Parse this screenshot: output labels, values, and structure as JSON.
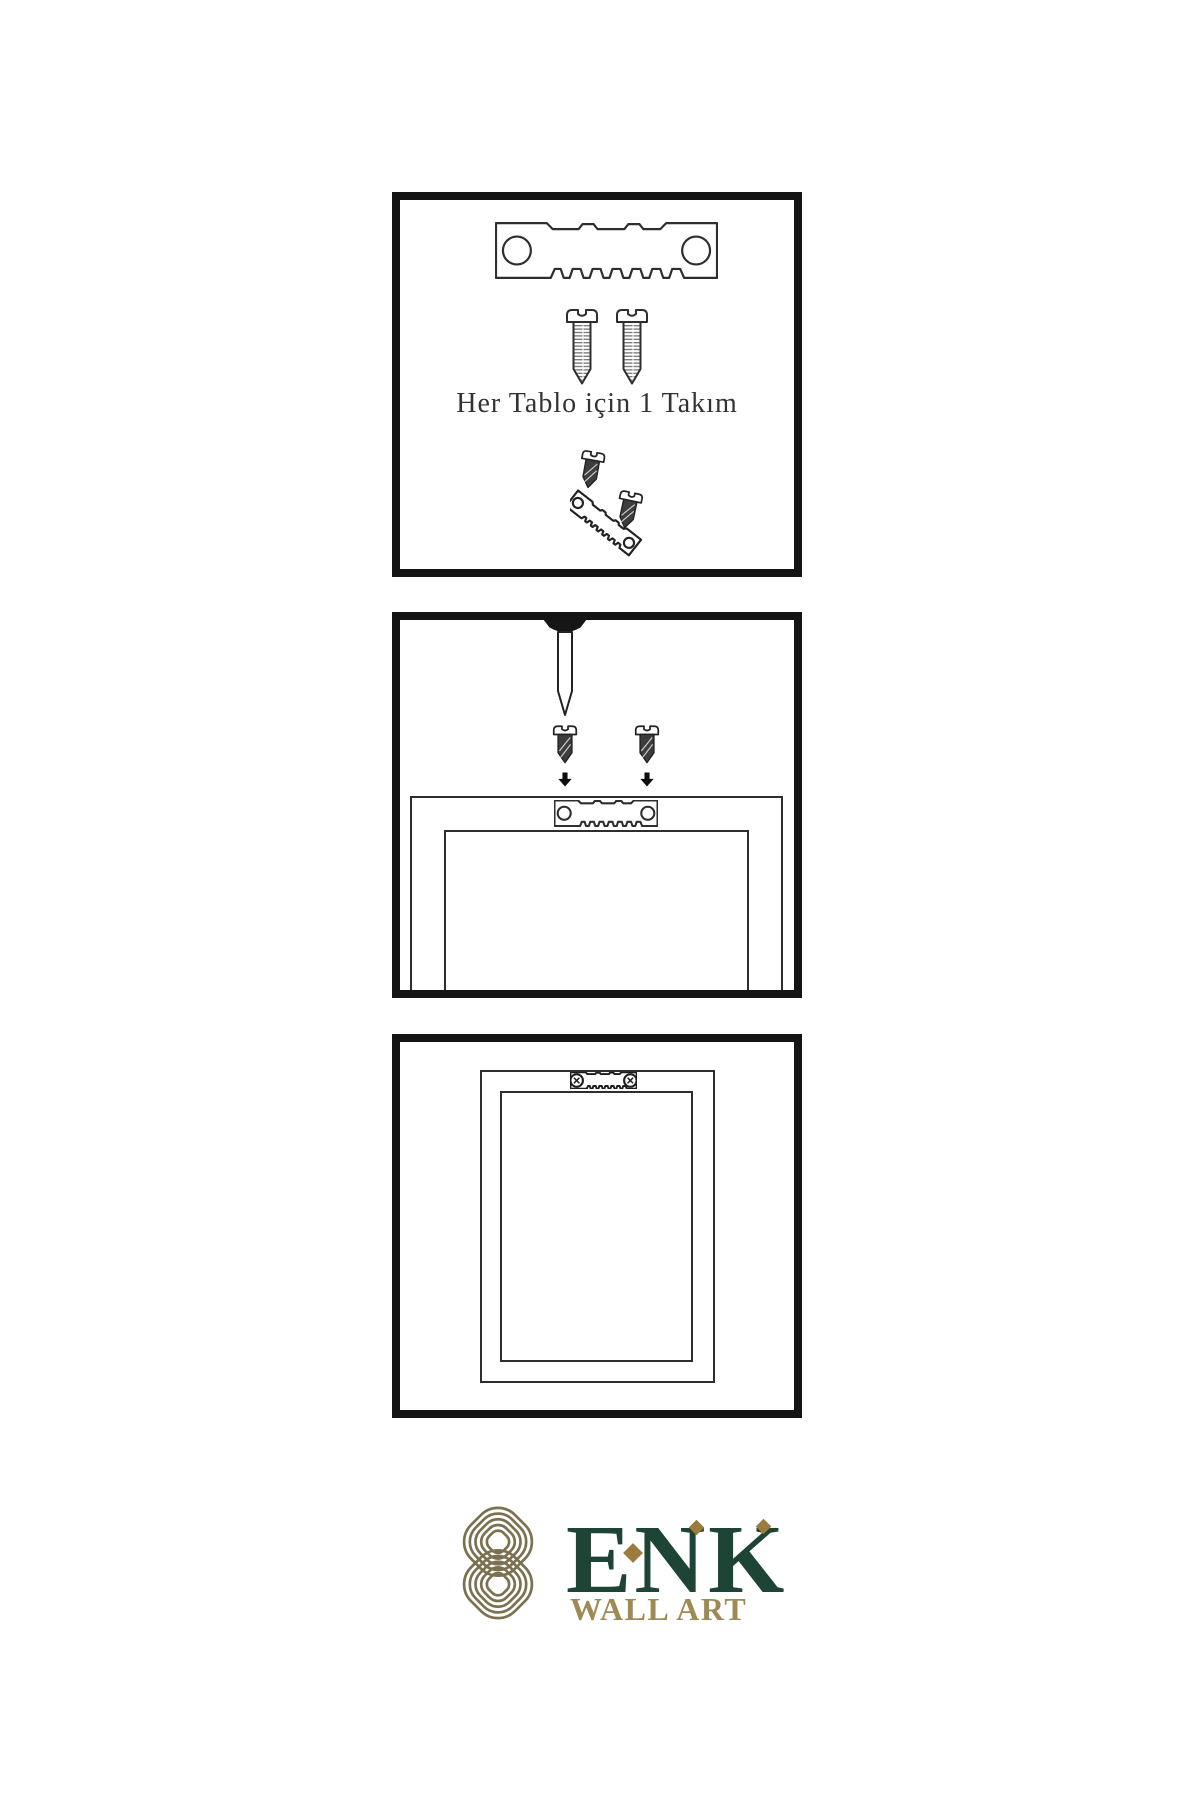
{
  "steps": {
    "step1": {
      "caption": "Her Tablo için 1 Takım",
      "icons": [
        "sawtooth-hanger-icon",
        "screw-icon",
        "screw-icon",
        "tilted-hanger-with-screws-icon"
      ]
    },
    "step2": {
      "icons": [
        "nail-icon",
        "screw-icon",
        "screw-icon",
        "arrow-down-icon",
        "arrow-down-icon",
        "frame-back-with-sawtooth-hanger"
      ]
    },
    "step3": {
      "icons": [
        "framed-picture-back-with-mounted-hanger"
      ]
    }
  },
  "brand": {
    "name": "ENK",
    "subtitle": "WALL ART"
  },
  "colors": {
    "background": "#ffffff",
    "panel_border": "#141414",
    "line_art": "#2e2e2e",
    "caption_text": "#333333",
    "screw_dark_fill": "#3d3d3d",
    "brand_green": "#1d4434",
    "brand_diamond_gold": "#9c7c3c",
    "brand_subtitle_gold": "#9d8a55",
    "knot_olive": "#7b7150"
  }
}
